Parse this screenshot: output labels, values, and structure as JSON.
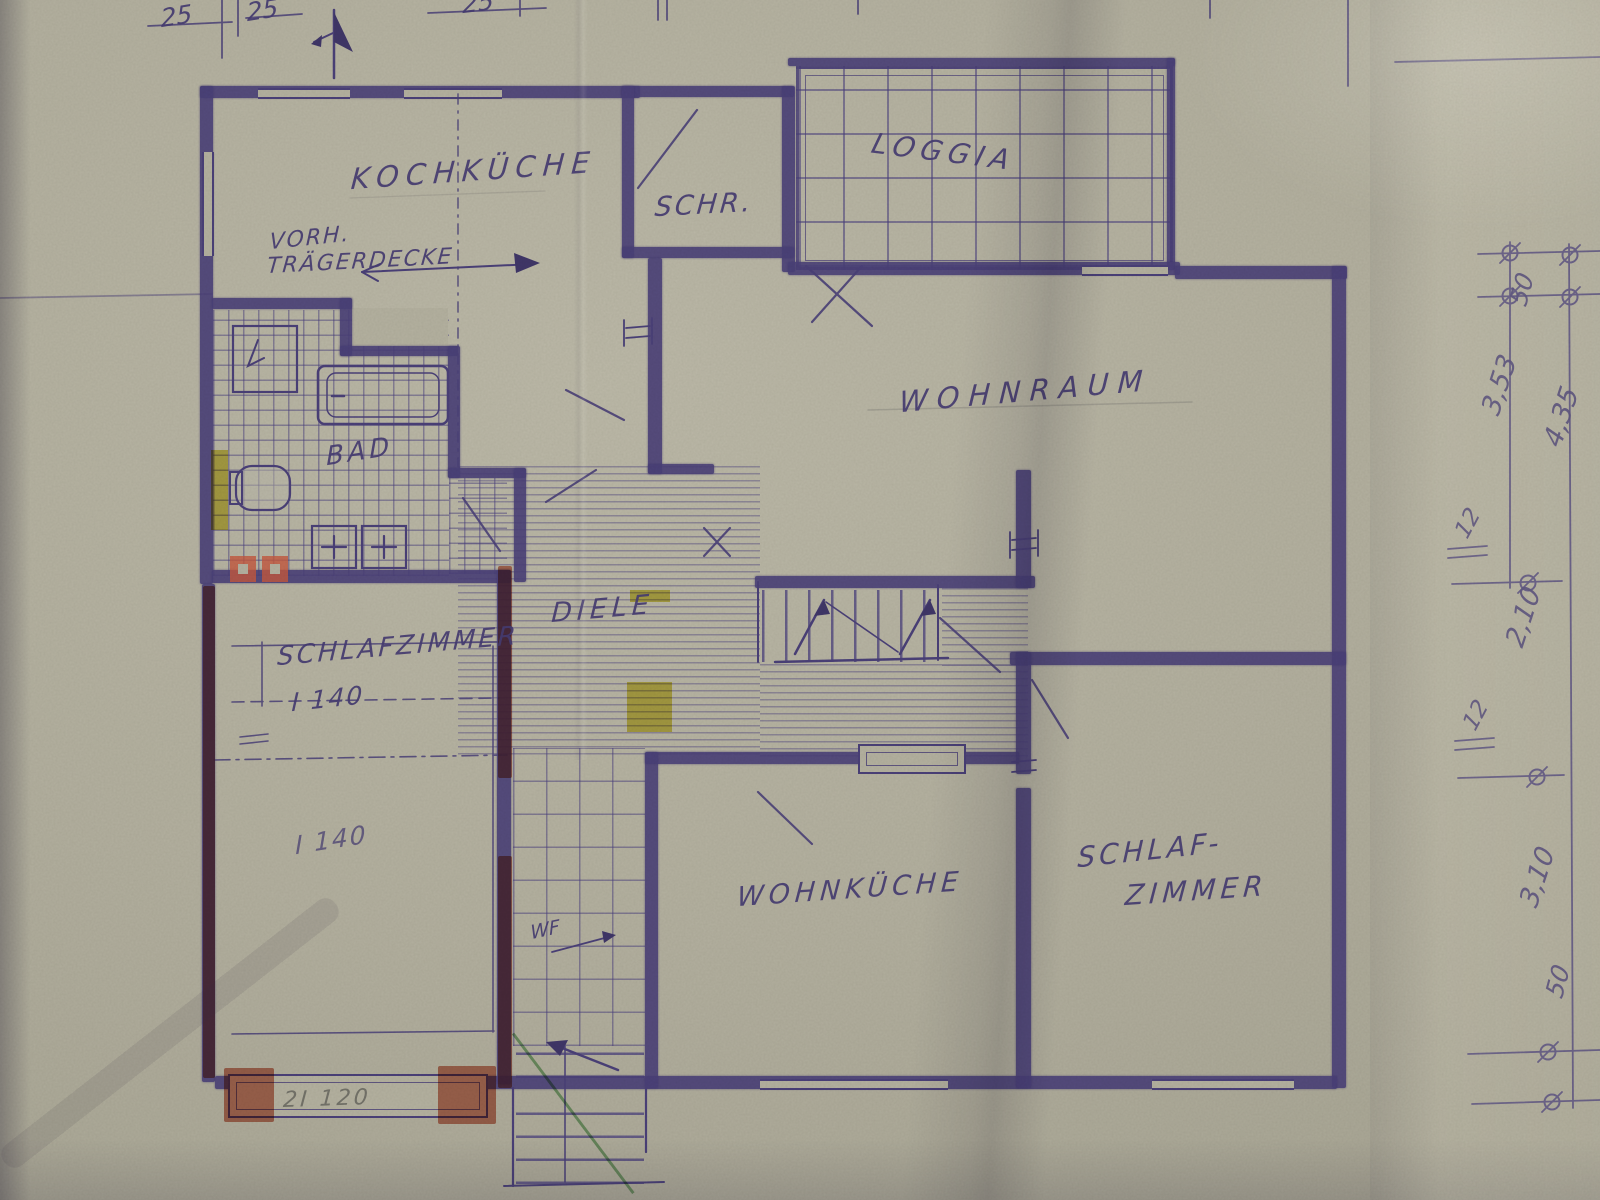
{
  "plan": {
    "room_labels": {
      "kochkueche": "KOCHKÜCHE",
      "schrank": "SCHR.",
      "loggia": "LOGGIA",
      "wohnraum": "WOHNRAUM",
      "bad": "BAD",
      "diele": "DIELE",
      "schlafzimmer_left": "SCHLAFZIMMER",
      "wohnkueche": "WOHNKÜCHE",
      "schlafzimmer_right_line1": "SCHLAF-",
      "schlafzimmer_right_line2": "ZIMMER"
    },
    "annotations": {
      "vorh": "VORH.",
      "traegerdecke": "TRÄGERDECKE",
      "bed1": "I 140",
      "bed2": "I 140",
      "wf": "WF",
      "beam_note": "2I 120"
    },
    "dimensions": {
      "top": [
        "25",
        "25",
        "25"
      ],
      "right": [
        "50",
        "3,53",
        "4,35",
        "12",
        "2,10",
        "12",
        "3,10",
        "50"
      ]
    },
    "colors": {
      "ink": "#473d74",
      "paper": "#b4b1a0",
      "red_correction": "#c05a41",
      "yellow_marker": "#d6cb41",
      "green_pencil": "#78b577",
      "pencil": "#75746b"
    }
  }
}
